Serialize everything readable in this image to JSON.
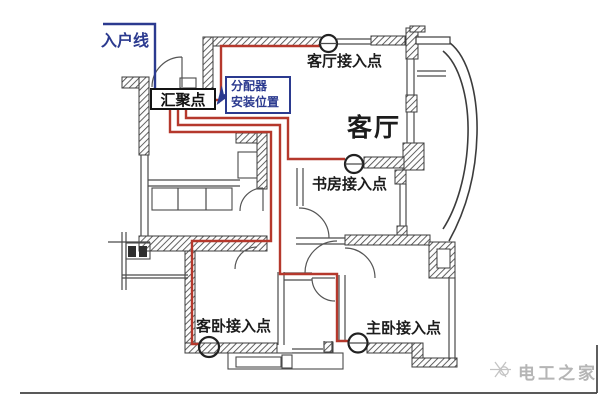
{
  "diagram": {
    "annotations": {
      "entry_line": "入户线",
      "hub": "汇聚点",
      "splitter_location": [
        "分配器",
        "安装位置"
      ],
      "room_living": "客厅",
      "ap_living": "客厅接入点",
      "ap_study": "书房接入点",
      "ap_guest_bedroom": "客卧接入点",
      "ap_master_bedroom": "主卧接入点"
    },
    "watermark": "电工之家",
    "colors": {
      "cable_red": "#b5382c",
      "entry_blue": "#2b3a8f",
      "wall_dark": "#3c3c3c",
      "watermark_gray": "#b5b5b5"
    }
  }
}
